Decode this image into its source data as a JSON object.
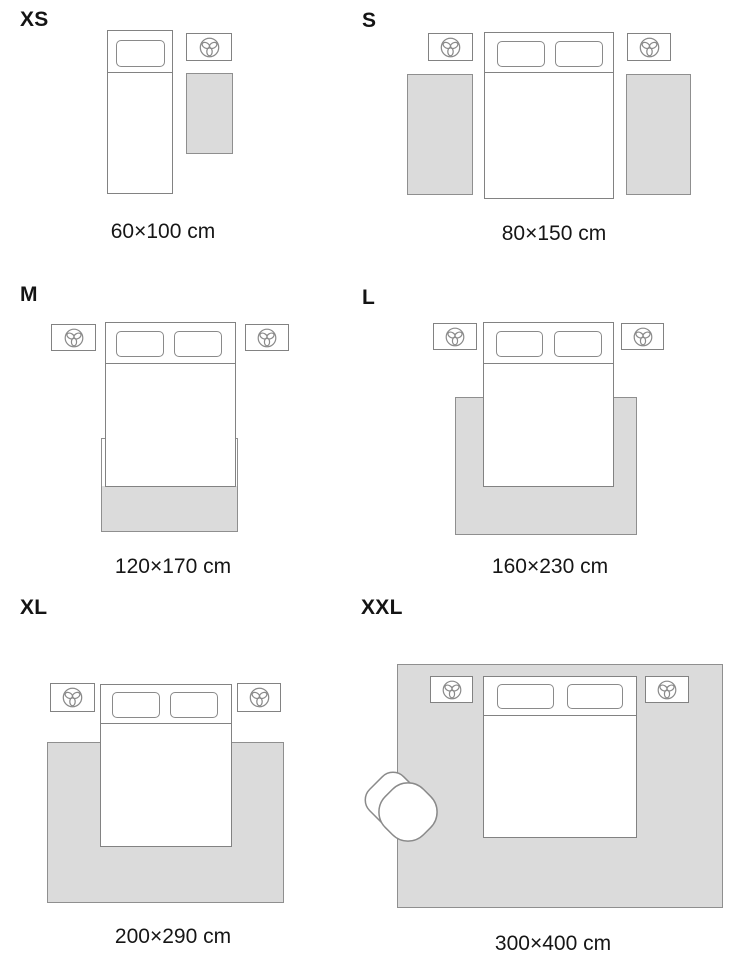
{
  "title": "Rug size guide",
  "legend": {
    "items": [
      {
        "tier": "XS",
        "dimensions": "60×100 cm"
      },
      {
        "tier": "S",
        "dimensions": "80×150 cm"
      },
      {
        "tier": "M",
        "dimensions": "120×170 cm"
      },
      {
        "tier": "L",
        "dimensions": "160×230 cm"
      },
      {
        "tier": "XL",
        "dimensions": "200×290 cm"
      },
      {
        "tier": "XXL",
        "dimensions": "300×400 cm"
      }
    ]
  },
  "icons": {
    "nightstand": "plant-icon",
    "armchair": "armchair-top-view"
  },
  "colors": {
    "background": "#ffffff",
    "rug_fill": "#dbdbdb",
    "outline": "#828282",
    "rug_outline": "#8f8f8f",
    "text": "#141414"
  }
}
